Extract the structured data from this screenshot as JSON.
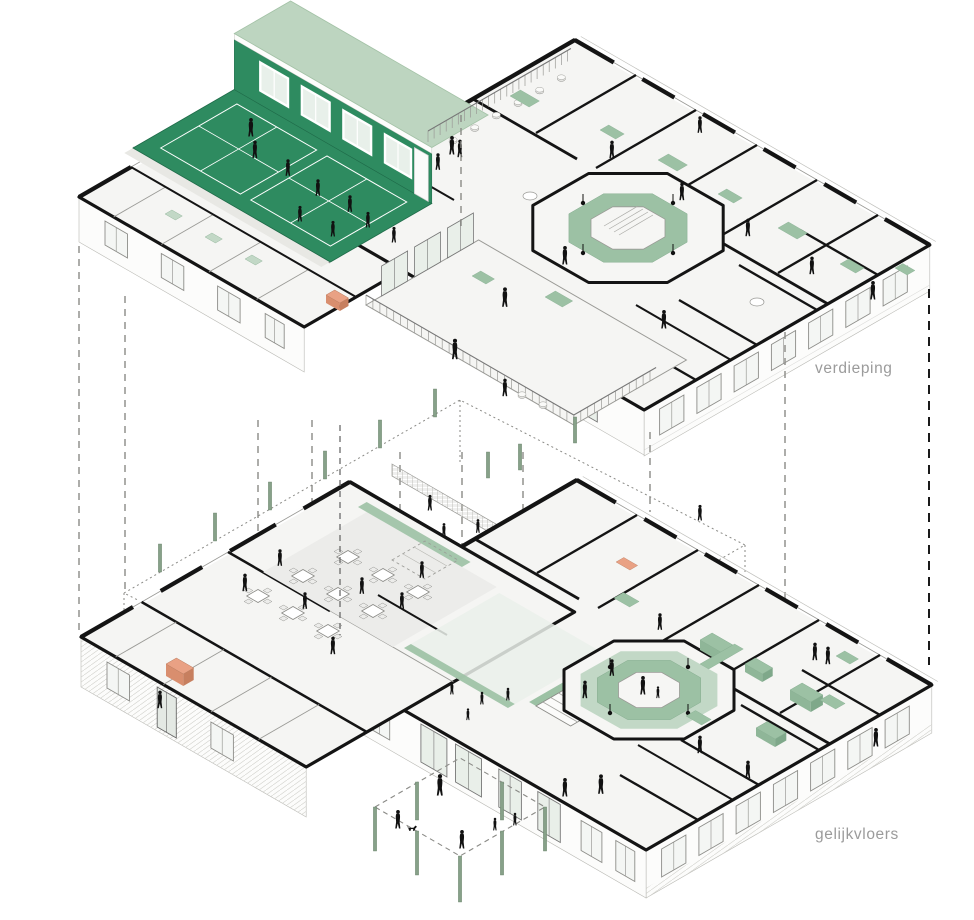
{
  "document": {
    "type": "exploded axonometric floor plan diagram",
    "language": "Dutch"
  },
  "floors": [
    {
      "id": "upper",
      "label": "verdieping"
    },
    {
      "id": "ground",
      "label": "gelijkvloers"
    }
  ],
  "label_color": "#9b9b9b",
  "colors": {
    "background": "#ffffff",
    "hall_green": "#2e8b60",
    "roof_green": "#bdd5c0",
    "sage": "#9cc1a4",
    "sage_light": "#c2d8c6",
    "column_green": "#87a189",
    "salmon": "#e9a184",
    "salmon_dark": "#d98e6e",
    "wall": "#141414",
    "plate": "#f5f5f3",
    "facade": "#fcfcfb",
    "line": "#9a9a96",
    "dash": "#8a8a86",
    "figure": "#111111",
    "court_line": "#ffffff",
    "glass": "#e9efe9"
  }
}
